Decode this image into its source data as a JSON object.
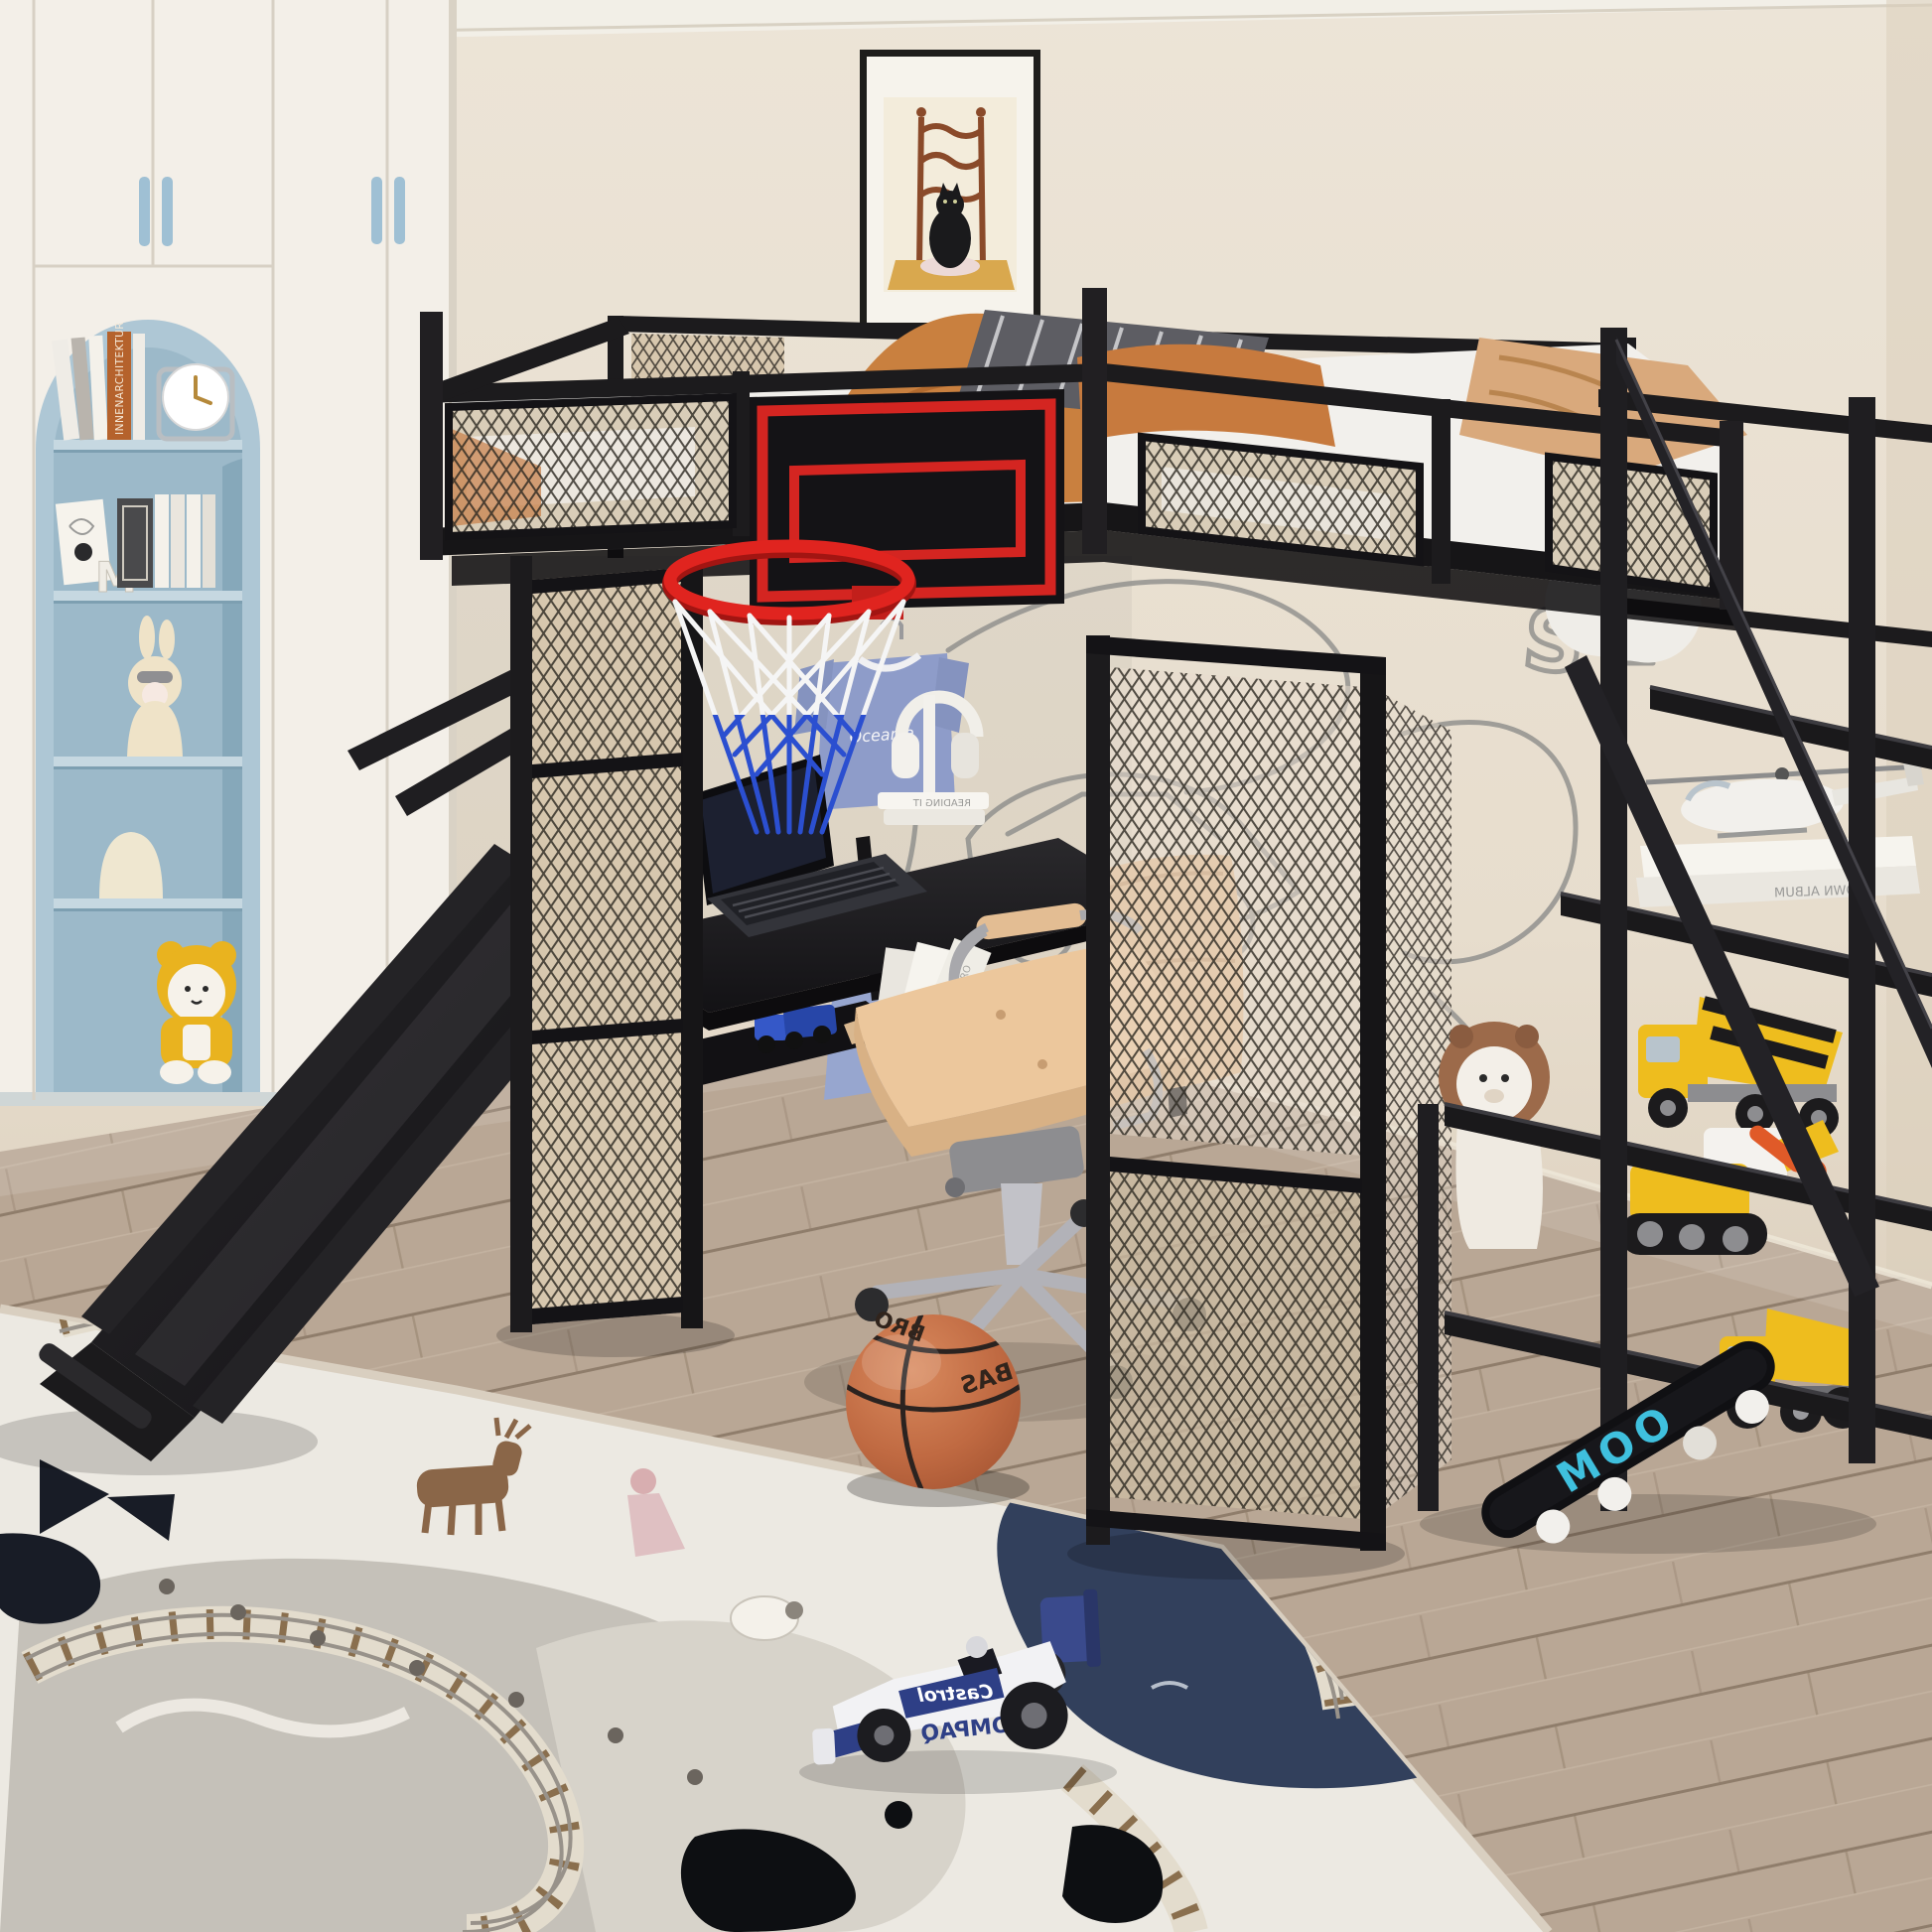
{
  "meta": {
    "title": "Kids bedroom with black metal full-size loft bed with desk, basketball hoop, slide and staircase shelves",
    "style": "3D product render photo"
  },
  "texts": {
    "book_spine": "INNENARCHITEKTUR",
    "letter_m": "M",
    "shirt_logo": "Oceania",
    "desk_books": "READING IT",
    "floor_books": "LIBRO",
    "stair_books": "CROWN ALBUM",
    "ball_text_a": "BAS",
    "ball_text_b": "BRO",
    "car_side": "Castrol",
    "car_body": "COMPAQ",
    "skateboard": "MOO",
    "decal_letter": "S"
  },
  "colors": {
    "wall": "#e9e0d2",
    "floor_wood": "#b9a795",
    "metal_black": "#1c1b1d",
    "mesh_beige": "#d7c7ae",
    "accent_red": "#d42521",
    "net_blue": "#2b4fd0",
    "bedding_orange": "#c9803f",
    "blanket_tan": "#d9a97c",
    "chair_tan": "#e9c79c",
    "niche_blue": "#a9c4d3",
    "wardrobe_white": "#f3efe8",
    "rug_cream": "#ece9e2",
    "rug_pond_navy": "#32405c",
    "toy_yellow": "#eebd1e",
    "skateboard_cyan": "#3fc0de",
    "basketball": "#c06a42",
    "car_blue": "#2e3f86"
  },
  "objects": [
    {
      "name": "loft-bed",
      "description": "Black metal full loft bed with mesh guard panels, orange and grey bedding"
    },
    {
      "name": "basketball-backboard",
      "description": "Black backboard with red border, red rim, white and blue net"
    },
    {
      "name": "slide",
      "description": "Black metal slide descending to the left onto the rug"
    },
    {
      "name": "staircase-shelves",
      "description": "Right-side stair with open black shelves holding toy helicopter, books, mixer truck, bulldozer, dump truck"
    },
    {
      "name": "desk",
      "description": "Black desk under bed with laptop, white headphones on book stack, hanging blue t-shirt"
    },
    {
      "name": "office-chair",
      "description": "Tan leather swivel chair with silver star base"
    },
    {
      "name": "wardrobe",
      "description": "White wardrobe wall with blue arched niche shelf: books, clock, bunny figurine, yellow bear plush"
    },
    {
      "name": "framed-art",
      "description": "Framed picture of a black cat on a wooden chair"
    },
    {
      "name": "rug",
      "description": "Cream playmat rug with train tracks, navy pond, grey hills and little animals"
    },
    {
      "name": "basketball",
      "description": "Orange basketball on wood floor"
    },
    {
      "name": "toy-f1-car",
      "description": "White and blue formula one toy car on the rug"
    },
    {
      "name": "skateboard",
      "description": "Black deck with cyan lettering leaning under the stairs"
    },
    {
      "name": "lion-plush",
      "description": "White plush with brown mane behind the stairs"
    }
  ]
}
